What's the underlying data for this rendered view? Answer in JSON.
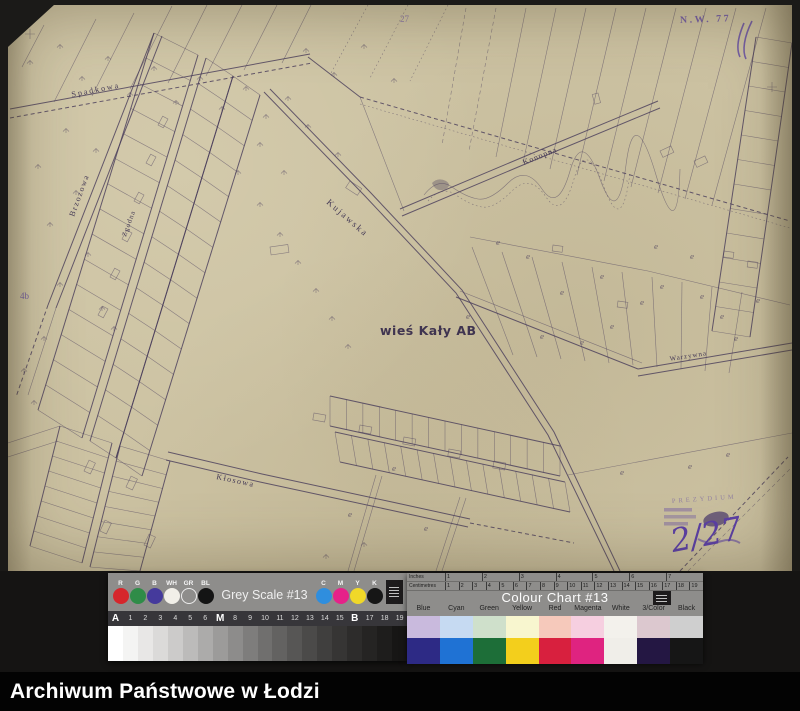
{
  "map": {
    "village_label": "wieś Kały AB",
    "streets": {
      "spadkowa": "Spadkowa",
      "brzozowa": "Brzozowa",
      "zgodna": "Zgodna",
      "kujawska": "Kujawska",
      "konopna": "Konopna",
      "warzywna": "Warzywna",
      "klosowa": "Kłosowa"
    },
    "stamps": {
      "sheet_code": "N.W. 77",
      "top_number": "27",
      "edge_number": "4b",
      "handwritten_fraction": "2/27",
      "office_stamp_fragment": "PREZYDIUM"
    },
    "parcel_symbol": "e",
    "ink_color": "#4b3e5c",
    "stamp_color": "#5f46a5",
    "paper_color": "#ccc2a2"
  },
  "greyscale_chart": {
    "title": "Grey Scale #13",
    "dots_left": [
      {
        "label": "R",
        "color": "#d6262c",
        "border": "transparent"
      },
      {
        "label": "G",
        "color": "#2f8c48",
        "border": "transparent"
      },
      {
        "label": "B",
        "color": "#453a9c",
        "border": "transparent"
      },
      {
        "label": "WH",
        "color": "#f1efe8",
        "border": "transparent"
      },
      {
        "label": "GR",
        "color": "#8e8d8b",
        "border": "#ececec"
      },
      {
        "label": "BL",
        "color": "#141414",
        "border": "transparent"
      }
    ],
    "dots_right": [
      {
        "label": "C",
        "color": "#2f8ede",
        "border": "transparent"
      },
      {
        "label": "M",
        "color": "#e62289",
        "border": "transparent"
      },
      {
        "label": "Y",
        "color": "#f0d829",
        "border": "transparent"
      },
      {
        "label": "K",
        "color": "#161616",
        "border": "transparent"
      }
    ],
    "tick_labels": [
      "A",
      "1",
      "2",
      "3",
      "4",
      "5",
      "6",
      "M",
      "8",
      "9",
      "10",
      "11",
      "12",
      "13",
      "14",
      "15",
      "B",
      "17",
      "18",
      "19"
    ],
    "steps": [
      "#ffffff",
      "#f4f4f3",
      "#e8e7e6",
      "#dbdad9",
      "#cccbca",
      "#bcbbba",
      "#acabaa",
      "#9c9b9a",
      "#8d8c8b",
      "#7e7d7c",
      "#706f6e",
      "#636261",
      "#575655",
      "#4b4a49",
      "#403f3e",
      "#363534",
      "#2d2c2b",
      "#252423",
      "#1e1d1c",
      "#171615"
    ]
  },
  "colour_chart": {
    "title": "Colour Chart #13",
    "ruler_top": "Inches",
    "ruler_bottom": "Centimetres",
    "inch_numbers": [
      "1",
      "2",
      "3",
      "4",
      "5",
      "6",
      "7"
    ],
    "cm_numbers": [
      "1",
      "2",
      "3",
      "4",
      "5",
      "6",
      "7",
      "8",
      "9",
      "10",
      "11",
      "12",
      "13",
      "14",
      "15",
      "16",
      "17",
      "18",
      "19"
    ],
    "columns": [
      {
        "label": "Blue",
        "light": "#c9badd",
        "dark": "#2d2a85"
      },
      {
        "label": "Cyan",
        "light": "#c6daf2",
        "dark": "#1f72d4"
      },
      {
        "label": "Green",
        "light": "#cfe0cb",
        "dark": "#1d6e38"
      },
      {
        "label": "Yellow",
        "light": "#f8f6cf",
        "dark": "#f3cf1c"
      },
      {
        "label": "Red",
        "light": "#f6c9bb",
        "dark": "#d8203e"
      },
      {
        "label": "Magenta",
        "light": "#f6cfe0",
        "dark": "#df2380"
      },
      {
        "label": "White",
        "light": "#f3f1ec",
        "dark": "#f0eee9"
      },
      {
        "label": "3/Color",
        "light": "#dcc8cf",
        "dark": "#241743"
      },
      {
        "label": "Black",
        "light": "#cfcfcf",
        "dark": "#161616"
      }
    ]
  },
  "footer": {
    "title": "Archiwum Państwowe w Łodzi"
  }
}
